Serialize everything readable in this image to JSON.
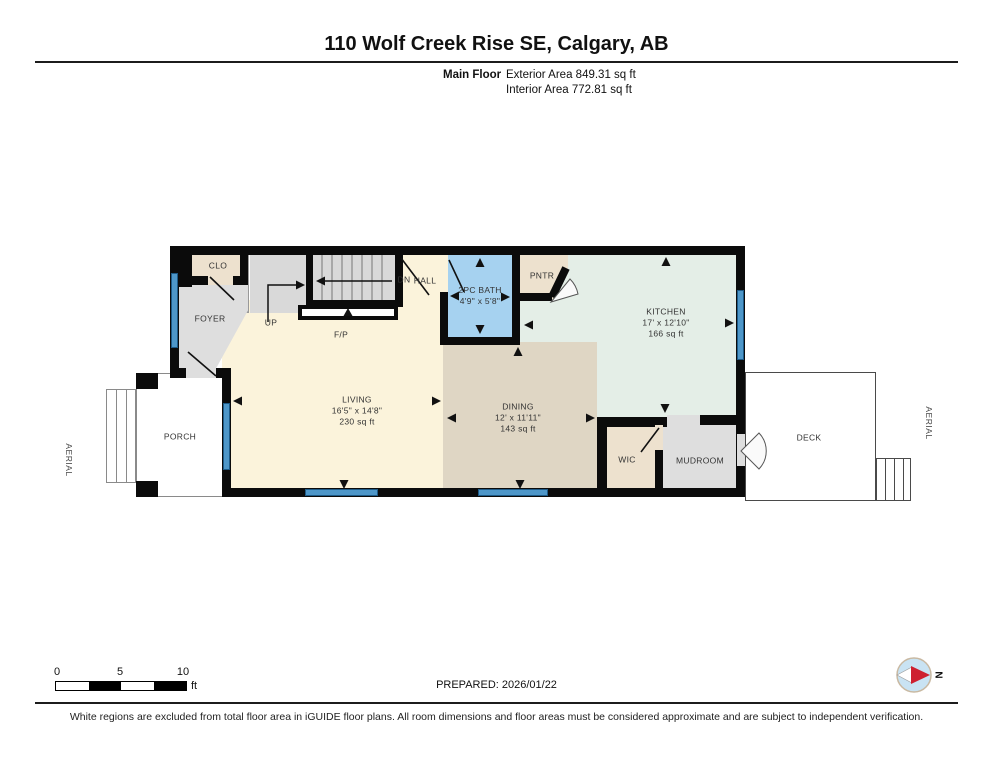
{
  "header": {
    "title": "110 Wolf Creek Rise SE, Calgary, AB",
    "floor_label": "Main Floor",
    "exterior_area": "Exterior Area 849.31 sq ft",
    "interior_area": "Interior Area 772.81 sq ft"
  },
  "plan": {
    "rooms": {
      "clo": {
        "label": "CLO"
      },
      "foyer": {
        "label": "FOYER"
      },
      "up": {
        "label": "UP"
      },
      "dn": {
        "label": "DN"
      },
      "hall": {
        "label": "HALL"
      },
      "fireplace": {
        "label": "F/P"
      },
      "bath": {
        "label": "2PC BATH",
        "dims": "4'9\" x 5'8\""
      },
      "pantry": {
        "label": "PNTR"
      },
      "kitchen": {
        "label": "KITCHEN",
        "dims": "17' x 12'10\"",
        "area": "166 sq ft"
      },
      "living": {
        "label": "LIVING",
        "dims": "16'5\" x 14'8\"",
        "area": "230 sq ft"
      },
      "dining": {
        "label": "DINING",
        "dims": "12' x 11'11\"",
        "area": "143 sq ft"
      },
      "wic": {
        "label": "WIC"
      },
      "mudroom": {
        "label": "MUDROOM"
      },
      "porch": {
        "label": "PORCH"
      },
      "deck": {
        "label": "DECK"
      }
    },
    "aerial_left": "AERIAL",
    "aerial_right": "AERIAL"
  },
  "footer": {
    "scale": {
      "ticks": [
        "0",
        "5",
        "10"
      ],
      "unit": "ft"
    },
    "prepared": "PREPARED: 2026/01/22",
    "compass_label": "N",
    "disclaimer": "White regions are excluded from total floor area in iGUIDE floor plans. All room dimensions and floor areas must be considered approximate and are subject to independent verification."
  },
  "colors": {
    "wall": "#0b0b0b",
    "window": "#4e97c9",
    "living": "#FBF3DB",
    "dining": "#DFD6C4",
    "kitchen": "#E4EEE7",
    "bath": "#A6D2F0",
    "closet_beige": "#EDE1CE",
    "gray_floor": "#DEDEDE",
    "stairs": "#D9D9D9",
    "compass_red": "#CE2030",
    "compass_blue": "#C9E3F3"
  }
}
